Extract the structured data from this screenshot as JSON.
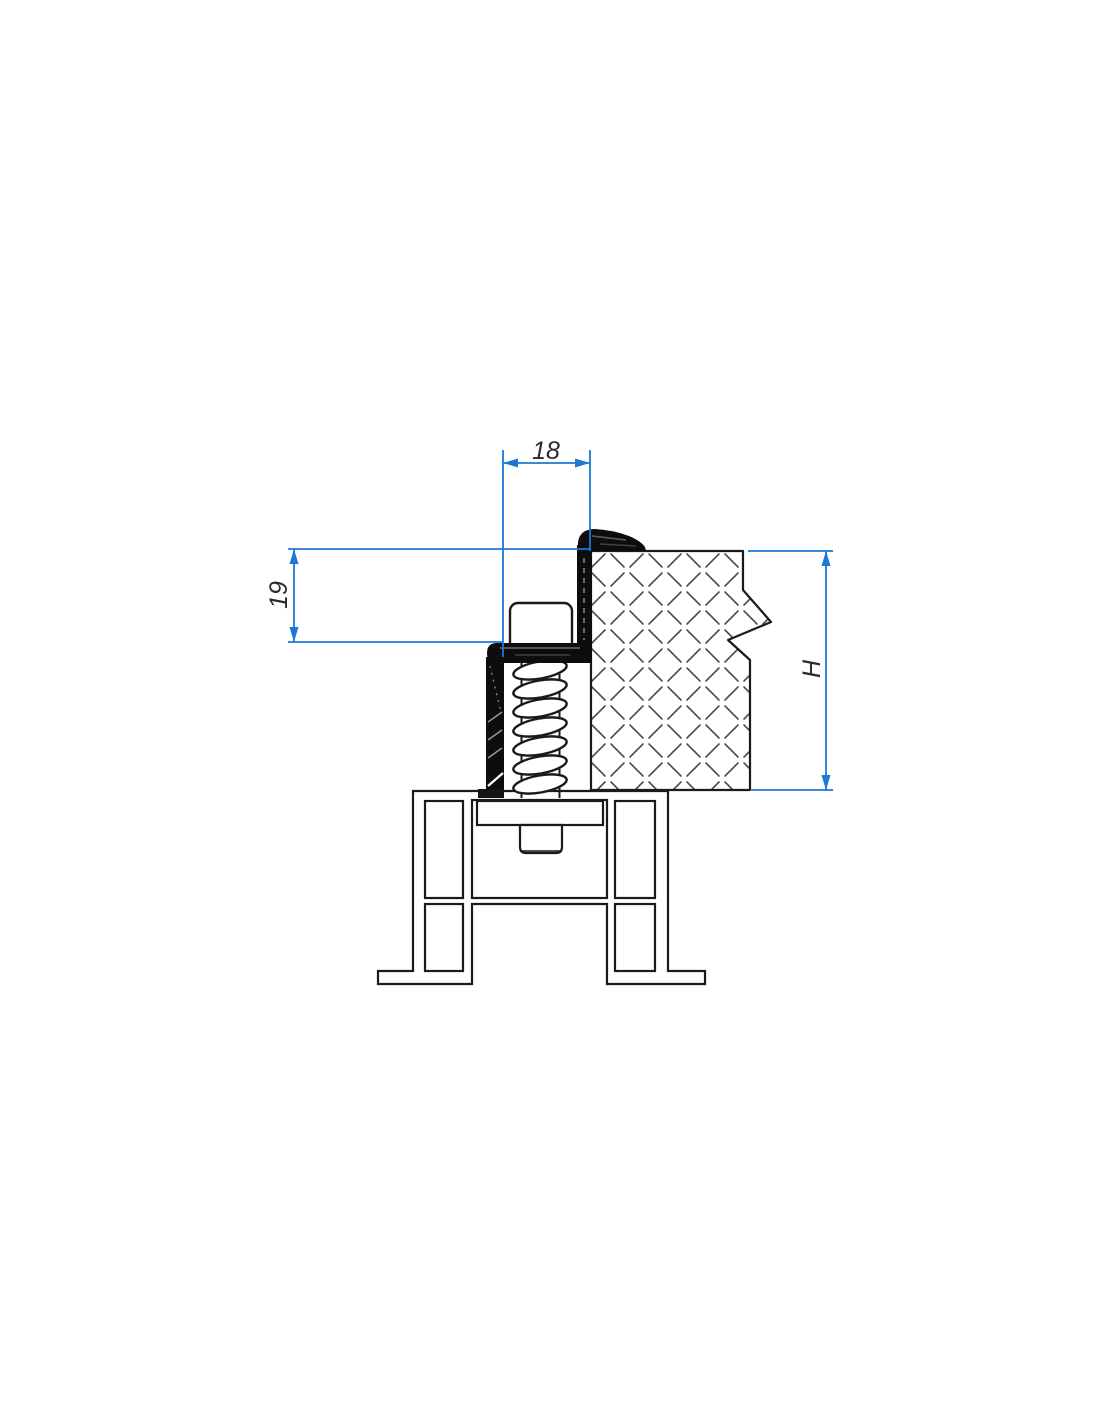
{
  "drawing": {
    "type": "technical-cross-section",
    "dimensions": {
      "clamp_width_label": "18",
      "clamp_height_label": "19",
      "panel_height_label": "H"
    },
    "colors": {
      "dimension_blue": "#1b78d6",
      "outline_black": "#1a1a1a",
      "hatch_gray": "#4d4d4d",
      "seal_black": "#0d0d0d"
    },
    "components": [
      "base-profile",
      "fixing-screw",
      "spring",
      "seal-clamp",
      "sandwich-panel"
    ]
  }
}
